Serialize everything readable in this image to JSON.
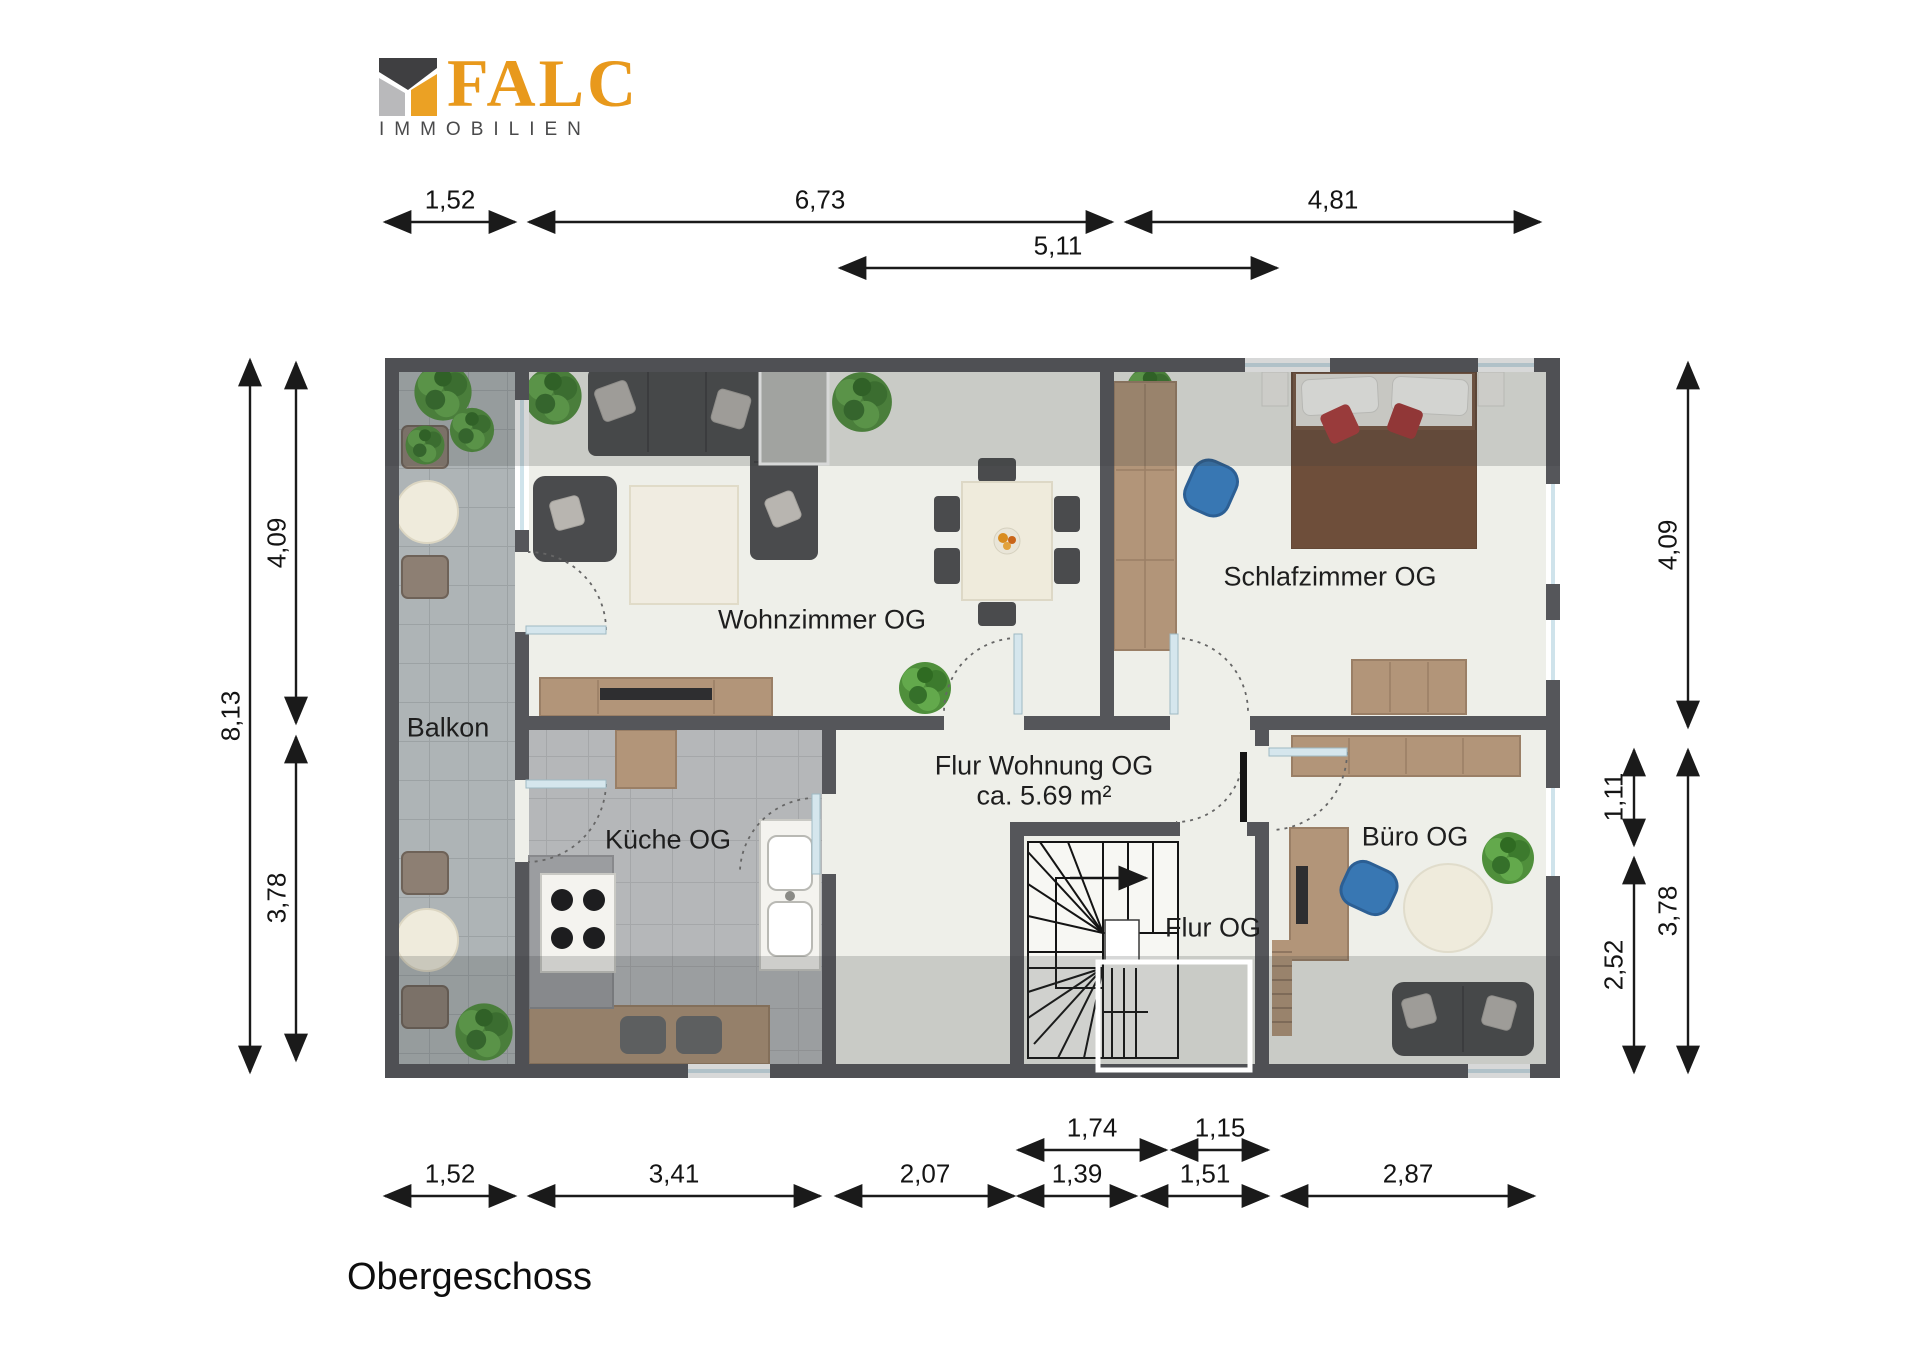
{
  "logo": {
    "brand": "FALC",
    "subtitle": "IMMOBILIEN"
  },
  "plan_title": "Obergeschoss",
  "rooms": {
    "balkon": {
      "label": "Balkon"
    },
    "wohnzimmer": {
      "label": "Wohnzimmer OG"
    },
    "schlafzimmer": {
      "label": "Schlafzimmer OG"
    },
    "kueche": {
      "label": "Küche OG"
    },
    "flur_wohnung": {
      "label": "Flur Wohnung OG",
      "area": "ca. 5.69 m²"
    },
    "flur": {
      "label": "Flur OG"
    },
    "buero": {
      "label": "Büro OG"
    }
  },
  "dimensions": {
    "top": [
      {
        "label": "1,52"
      },
      {
        "label": "6,73"
      },
      {
        "label": "4,81"
      }
    ],
    "top_inner": [
      {
        "label": "5,11"
      }
    ],
    "left_outer": [
      {
        "label": "8,13"
      }
    ],
    "left_inner": [
      {
        "label": "4,09"
      },
      {
        "label": "3,78"
      }
    ],
    "right_outer": [
      {
        "label": "4,09"
      },
      {
        "label": "3,78"
      }
    ],
    "right_inner": [
      {
        "label": "1,11"
      },
      {
        "label": "2,52"
      }
    ],
    "bottom_inner": [
      {
        "label": "1,74"
      },
      {
        "label": "1,15"
      }
    ],
    "bottom": [
      {
        "label": "1,52"
      },
      {
        "label": "3,41"
      },
      {
        "label": "2,07"
      },
      {
        "label": "1,39"
      },
      {
        "label": "1,51"
      },
      {
        "label": "2,87"
      }
    ]
  },
  "colors": {
    "brand_orange": "#E8991C",
    "brand_dark": "#3F3F41",
    "brand_gray": "#B9B9BB",
    "wall": "#55565A",
    "floor": "#EEEFE9",
    "tile": "#AEB4B6",
    "dimension_line": "#1A1A1A",
    "plant_green": "#4F8F3B",
    "accent_blue": "#3877B3"
  }
}
